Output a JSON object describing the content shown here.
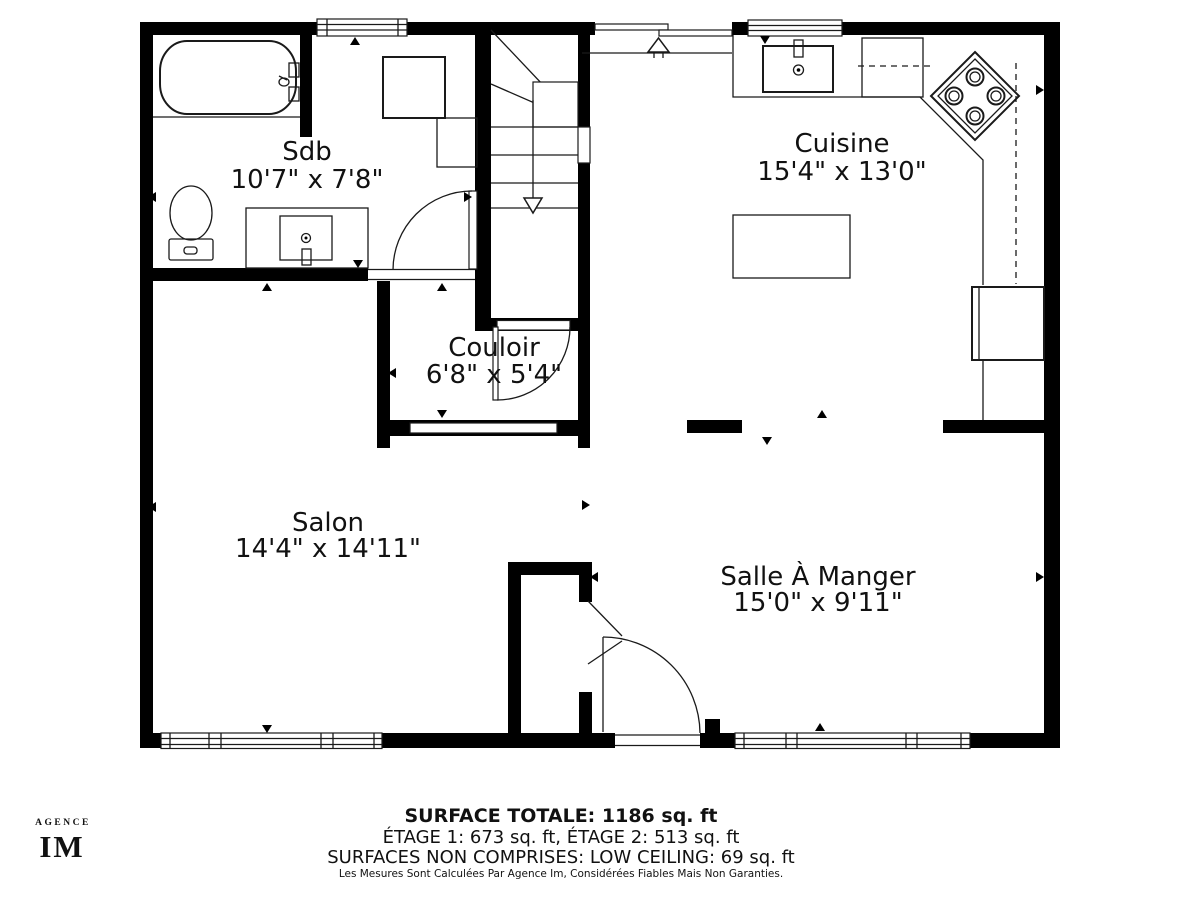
{
  "branding": {
    "agency_small": "AGENCE",
    "agency_initials": "IM"
  },
  "rooms": [
    {
      "id": "sdb",
      "name": "Sdb",
      "dimensions": "10'7\" x 7'8\""
    },
    {
      "id": "cuisine",
      "name": "Cuisine",
      "dimensions": "15'4\" x 13'0\""
    },
    {
      "id": "couloir",
      "name": "Couloir",
      "dimensions": "6'8\" x 5'4\""
    },
    {
      "id": "salon",
      "name": "Salon",
      "dimensions": "14'4\" x 14'11\""
    },
    {
      "id": "salle-a-manger",
      "name": "Salle À Manger",
      "dimensions": "15'0\" x 9'11\""
    }
  ],
  "summary": {
    "total": "SURFACE TOTALE: 1186 sq. ft",
    "floors": "ÉTAGE 1: 673 sq. ft, ÉTAGE 2: 513 sq. ft",
    "excluded": "SURFACES NON COMPRISES: LOW CEILING: 69 sq. ft",
    "disclaimer": "Les Mesures Sont Calculées Par Agence Im, Considérées Fiables Mais Non Garanties."
  },
  "colors": {
    "wall": "#000000",
    "line": "#1a1a1a",
    "background": "#ffffff"
  }
}
